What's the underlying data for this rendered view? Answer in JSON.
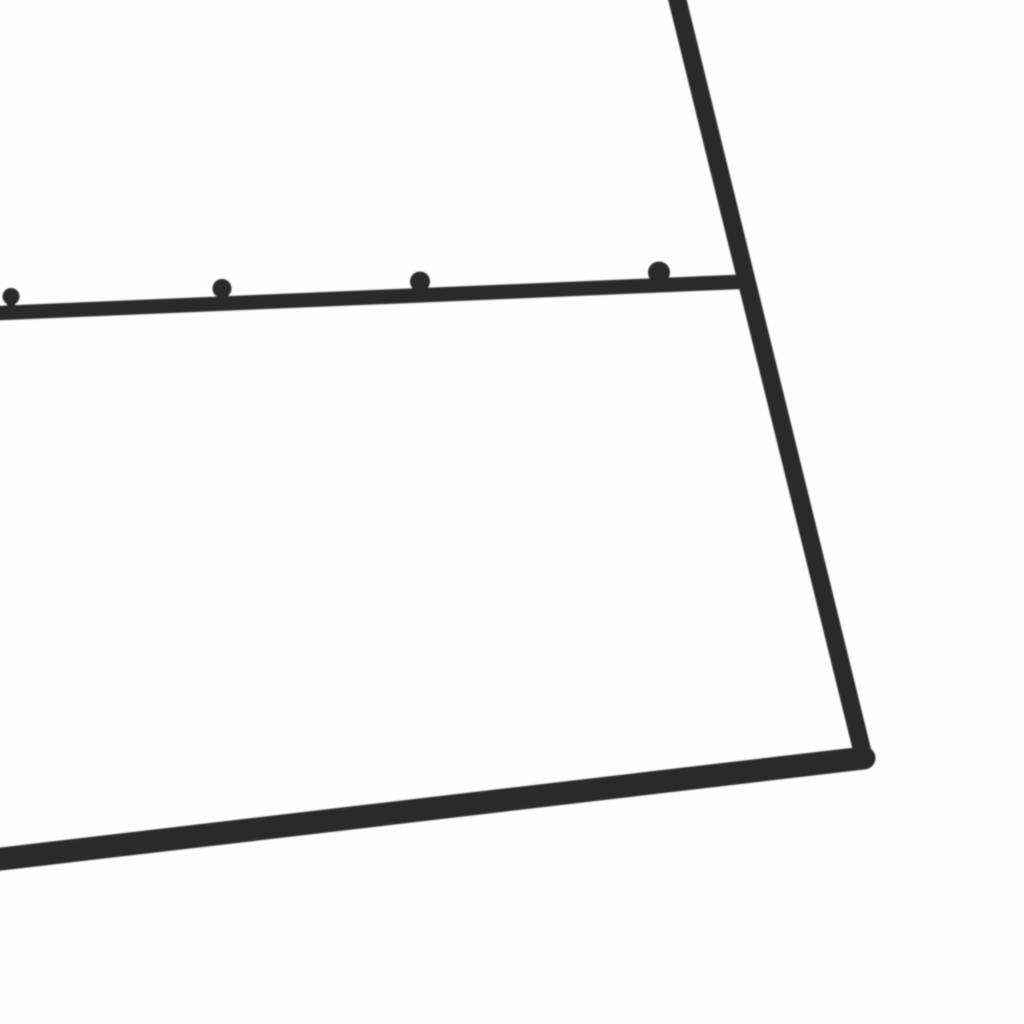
{
  "image": {
    "width": 1024,
    "height": 1024,
    "background_color": "#fefefe"
  },
  "frame": {
    "metal_color": "#2a2a2c",
    "metal_edge_soften_px": 0.7,
    "bars": [
      {
        "name": "side-rail-bar",
        "x1": 674,
        "y1": -14,
        "x2": 864,
        "y2": 758,
        "width": 18
      },
      {
        "name": "bottom-rail-bar",
        "x1": -16,
        "y1": 861,
        "x2": 864,
        "y2": 758,
        "width": 23
      },
      {
        "name": "hook-rail-bar",
        "x1": -12,
        "y1": 313.5,
        "x2": 748,
        "y2": 281.5,
        "width": 14.5
      }
    ],
    "hook_rail_index": 2,
    "knobs": [
      {
        "cx": 11,
        "cy": 296.5,
        "r": 8.5
      },
      {
        "cx": 222,
        "cy": 288.5,
        "r": 9.5
      },
      {
        "cx": 420,
        "cy": 281.5,
        "r": 10
      },
      {
        "cx": 659,
        "cy": 272.5,
        "r": 11
      }
    ],
    "stem_width": 8
  }
}
